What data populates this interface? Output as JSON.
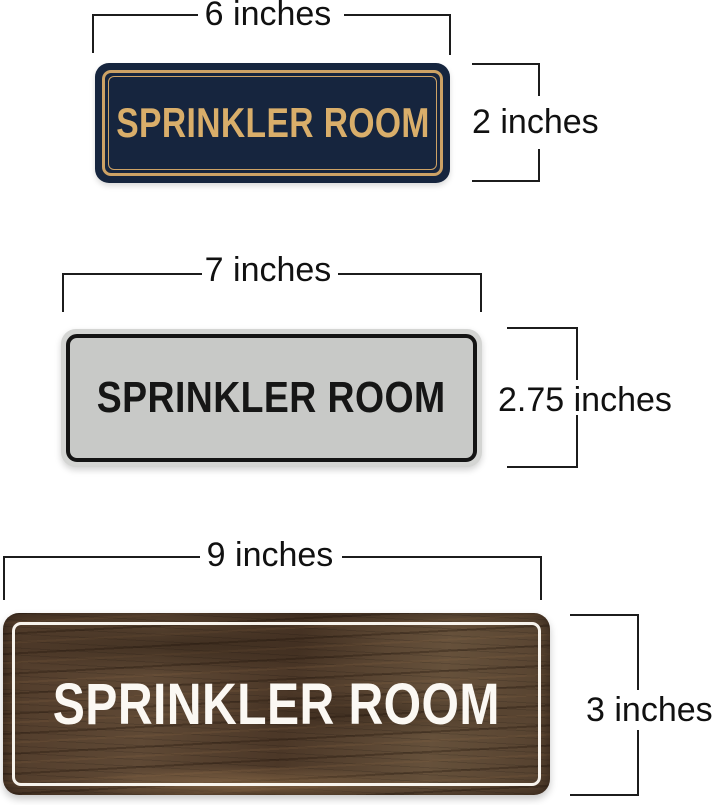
{
  "theme": {
    "page-bg": "#ffffff",
    "dim-line": "#1c1c1c",
    "dim-text": "#111111",
    "navy-body": "#16253e",
    "navy-border": "#cda265",
    "navy-text": "#d9ae6a",
    "silver-edge": "#d4d5d3",
    "silver-body": "#c8c9c7",
    "silver-border": "#141414",
    "silver-text": "#161616",
    "wood-base": "#55402e",
    "wood-border": "#f7f3ec",
    "wood-text": "#fbf8f3"
  },
  "signs": [
    {
      "name": "navy-gold-sign",
      "text": "SPRINKLER ROOM",
      "width_label": "6 inches",
      "height_label": "2 inches"
    },
    {
      "name": "silver-black-sign",
      "text": "SPRINKLER ROOM",
      "width_label": "7 inches",
      "height_label": "2.75 inches"
    },
    {
      "name": "walnut-wood-sign",
      "text": "SPRINKLER ROOM",
      "width_label": "9 inches",
      "height_label": "3 inches"
    }
  ]
}
